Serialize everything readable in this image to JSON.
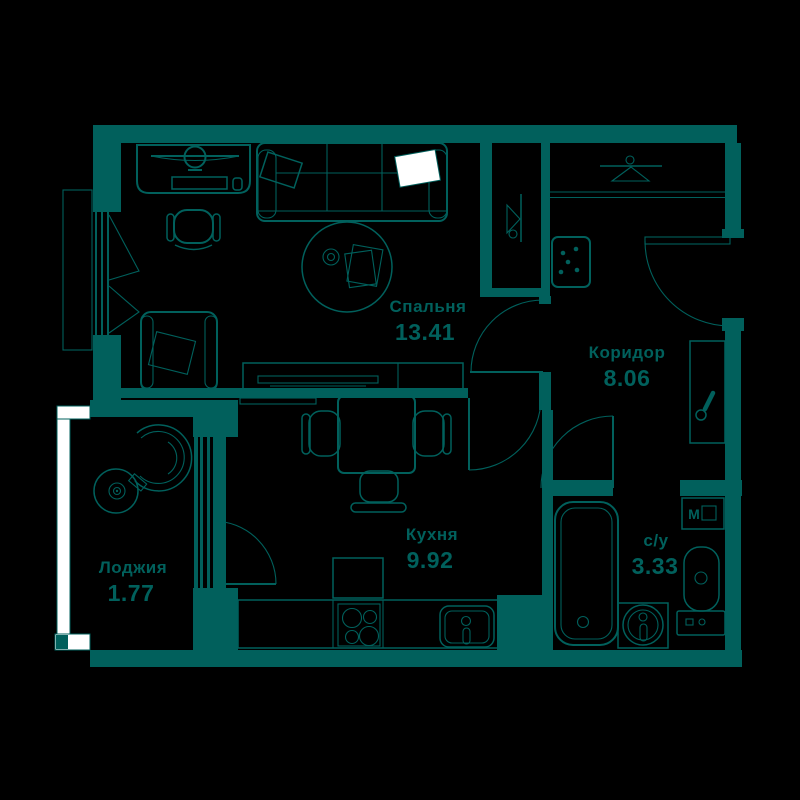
{
  "title": "Apartment floor plan",
  "colors": {
    "wall": "#01605c",
    "background": "#000000",
    "highlight": "#ffffff"
  },
  "rooms": {
    "bedroom": {
      "name": "Спальня",
      "area": "13.41"
    },
    "corridor": {
      "name": "Коридор",
      "area": "8.06"
    },
    "kitchen": {
      "name": "Кухня",
      "area": "9.92"
    },
    "loggia": {
      "name": "Лоджия",
      "area": "1.77"
    },
    "bathroom": {
      "name": "с/у",
      "area": "3.33"
    }
  },
  "appliances": {
    "washing_machine": "М"
  },
  "icons": [
    "hanger-icon",
    "electrical-panel-icon",
    "mirror-icon",
    "stove-burners-icon",
    "sink-faucet-icon",
    "door-swing-arc"
  ]
}
